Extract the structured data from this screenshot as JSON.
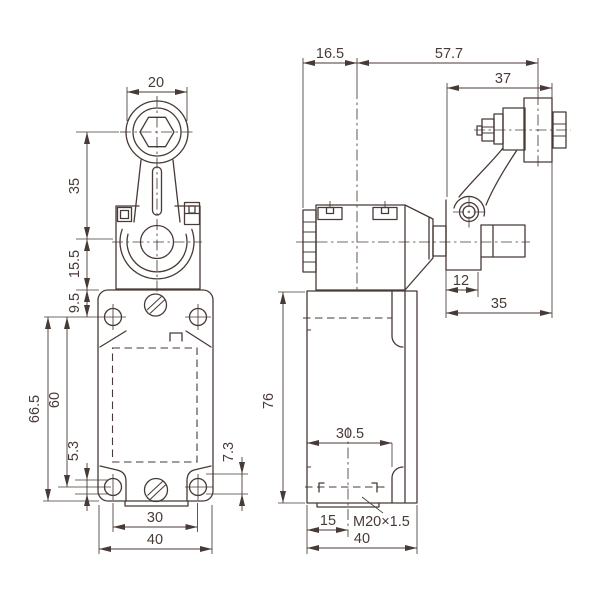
{
  "drawing": {
    "type": "limit-switch roller-lever dimensional drawing",
    "colors": {
      "line": "#483a36",
      "background": "#ffffff"
    },
    "front_view": {
      "dims": {
        "roller_width": "20",
        "lever_length": "35",
        "pivot_offset": "15.5",
        "top_hole_offset": "9.5",
        "hole_to_bottom": "66.5",
        "hole_pitch_vertical": "60",
        "slot_left": "5.3",
        "slot_right": "7.3",
        "hole_pitch_horizontal": "30",
        "body_width": "40"
      }
    },
    "side_view": {
      "dims": {
        "head_center_offset": "16.5",
        "center_to_roller": "57.7",
        "lever_span": "37",
        "bracket_width": "12",
        "lever_arm": "35",
        "body_height": "76",
        "conduit_depth": "30.5",
        "conduit_center": "15",
        "conduit_thread": "M20×1.5",
        "body_depth": "40"
      }
    }
  }
}
